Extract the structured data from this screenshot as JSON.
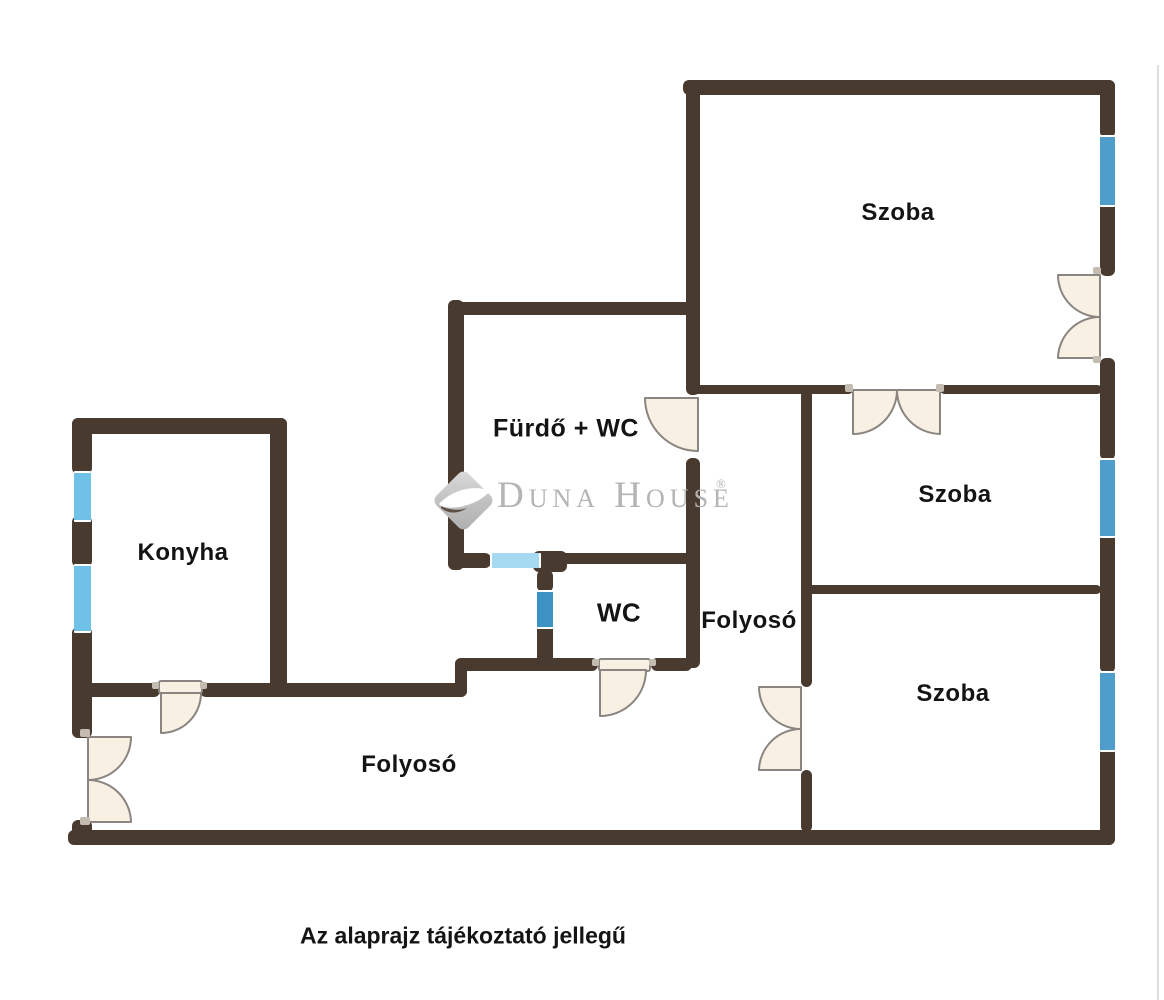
{
  "caption": "Az alaprajz tájékoztató jellegű",
  "logo": {
    "text": "Duna House",
    "registered_mark": "®"
  },
  "rooms": {
    "szoba_top": {
      "label": "Szoba"
    },
    "szoba_middle": {
      "label": "Szoba"
    },
    "szoba_bottom": {
      "label": "Szoba"
    },
    "konyha": {
      "label": "Konyha"
    },
    "furdo_wc": {
      "label": "Fürdő + WC"
    },
    "wc": {
      "label": "WC"
    },
    "folyoso_middle": {
      "label": "Folyosó"
    },
    "folyoso_main": {
      "label": "Folyosó"
    }
  },
  "colors": {
    "wall": "#483A2F",
    "door-fill": "#F8F1E3",
    "door-stroke": "#8A8580",
    "window-main": "#4E9DCB",
    "window-konyha": "#70C1E8",
    "window-furdo": "#A6DAF2",
    "window-wc": "#3D92C4",
    "label": "#141414",
    "logo-gray": "#B4B4B4",
    "edge-line": "#DEDEDE",
    "hinge": "#C4BBB1",
    "bg": "#FFFFFF"
  }
}
